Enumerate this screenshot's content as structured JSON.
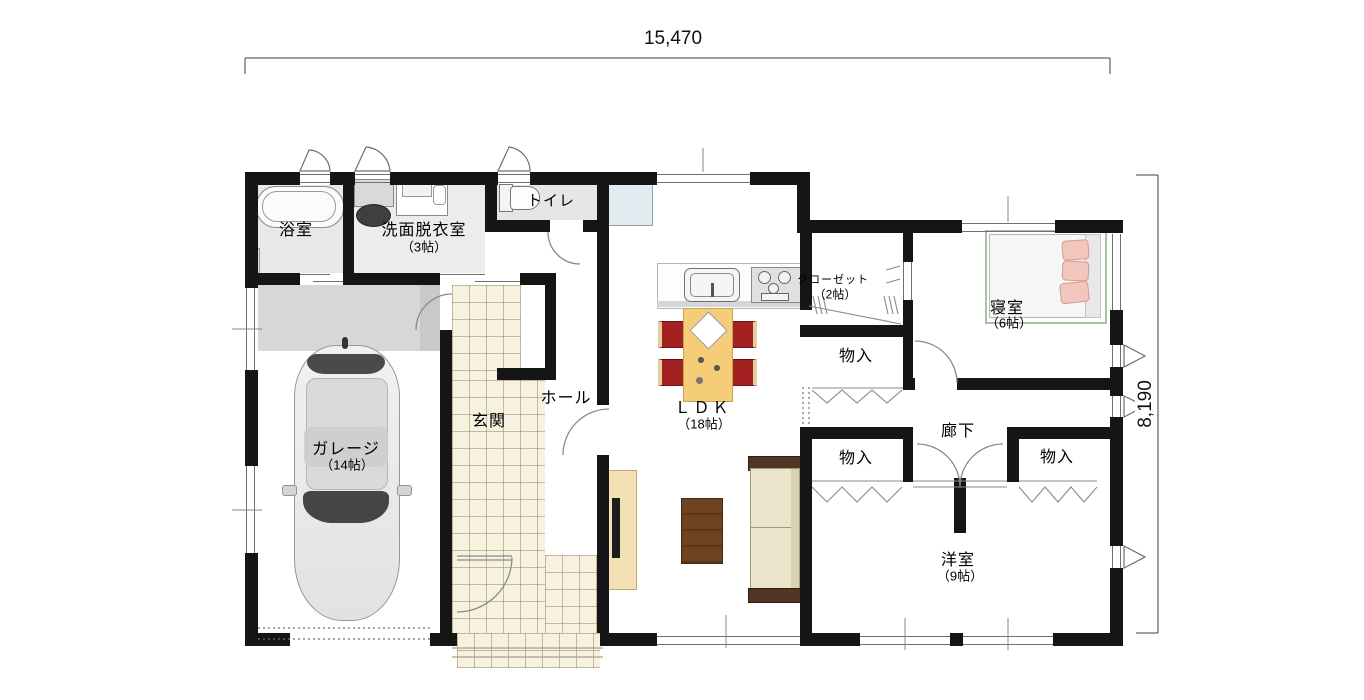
{
  "plan": {
    "dim_width": "15,470",
    "dim_height": "8,190",
    "rooms": {
      "bath": {
        "label": "浴室"
      },
      "washroom": {
        "label": "洗面脱衣室",
        "size": "（3帖）"
      },
      "toilet": {
        "label": "トイレ"
      },
      "entrance": {
        "label": "玄関"
      },
      "hall": {
        "label": "ホール"
      },
      "garage": {
        "label": "ガレージ",
        "size": "（14帖）"
      },
      "ldk": {
        "label": "ＬＤＫ",
        "size": "（18帖）"
      },
      "closet": {
        "label": "クローゼット",
        "size": "（2帖）"
      },
      "bedroom": {
        "label": "寝室",
        "size": "（6帖）"
      },
      "storage_north": {
        "label": "物入"
      },
      "storage_west": {
        "label": "物入"
      },
      "storage_east": {
        "label": "物入"
      },
      "corridor": {
        "label": "廊下"
      },
      "western_room": {
        "label": "洋室",
        "size": "（9帖）"
      }
    },
    "colors": {
      "wall": "#151515",
      "tile": "#f7f2df",
      "table": "#f5cd78",
      "chair": "#a32121",
      "apron_grey": "#d7d7d7",
      "sofa": "#eae4ca",
      "wood_table": "#6d4423"
    }
  }
}
